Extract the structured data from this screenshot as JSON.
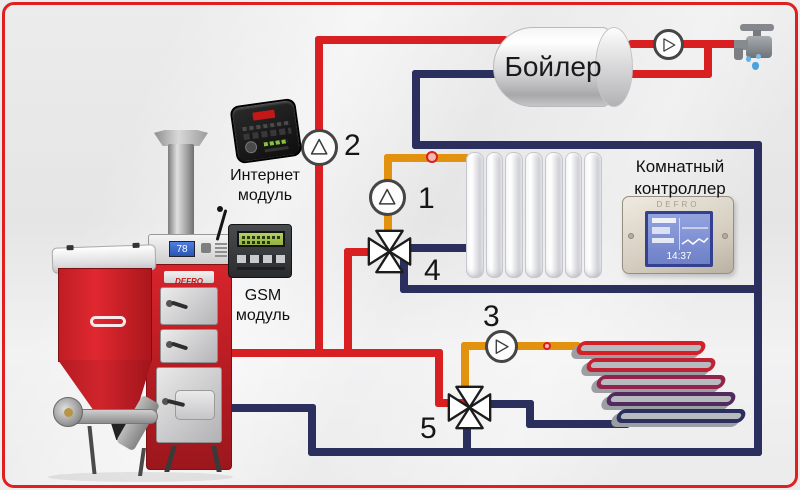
{
  "colors": {
    "hot_pipe": "#d81f22",
    "return_pipe": "#2b2f5e",
    "mixed_pipe": "#e2920e",
    "frame_border": "#e02020"
  },
  "labels": {
    "tank": "Бойлер",
    "internet_module": {
      "line1": "Интернет",
      "line2": "модуль"
    },
    "gsm_module": {
      "line1": "GSM",
      "line2": "модуль"
    },
    "room_controller": {
      "line1": "Комнатный",
      "line2": "контроллер"
    }
  },
  "markers": {
    "radiator_pump": "1",
    "tank_pump": "2",
    "floor_pump": "3",
    "radiator_valve": "4",
    "floor_valve": "5"
  },
  "devices": {
    "boiler_brand": "DEFRO",
    "boiler_display": "78",
    "room_controller_brand": "DEFRO",
    "room_controller_screen_value": "14:37"
  }
}
